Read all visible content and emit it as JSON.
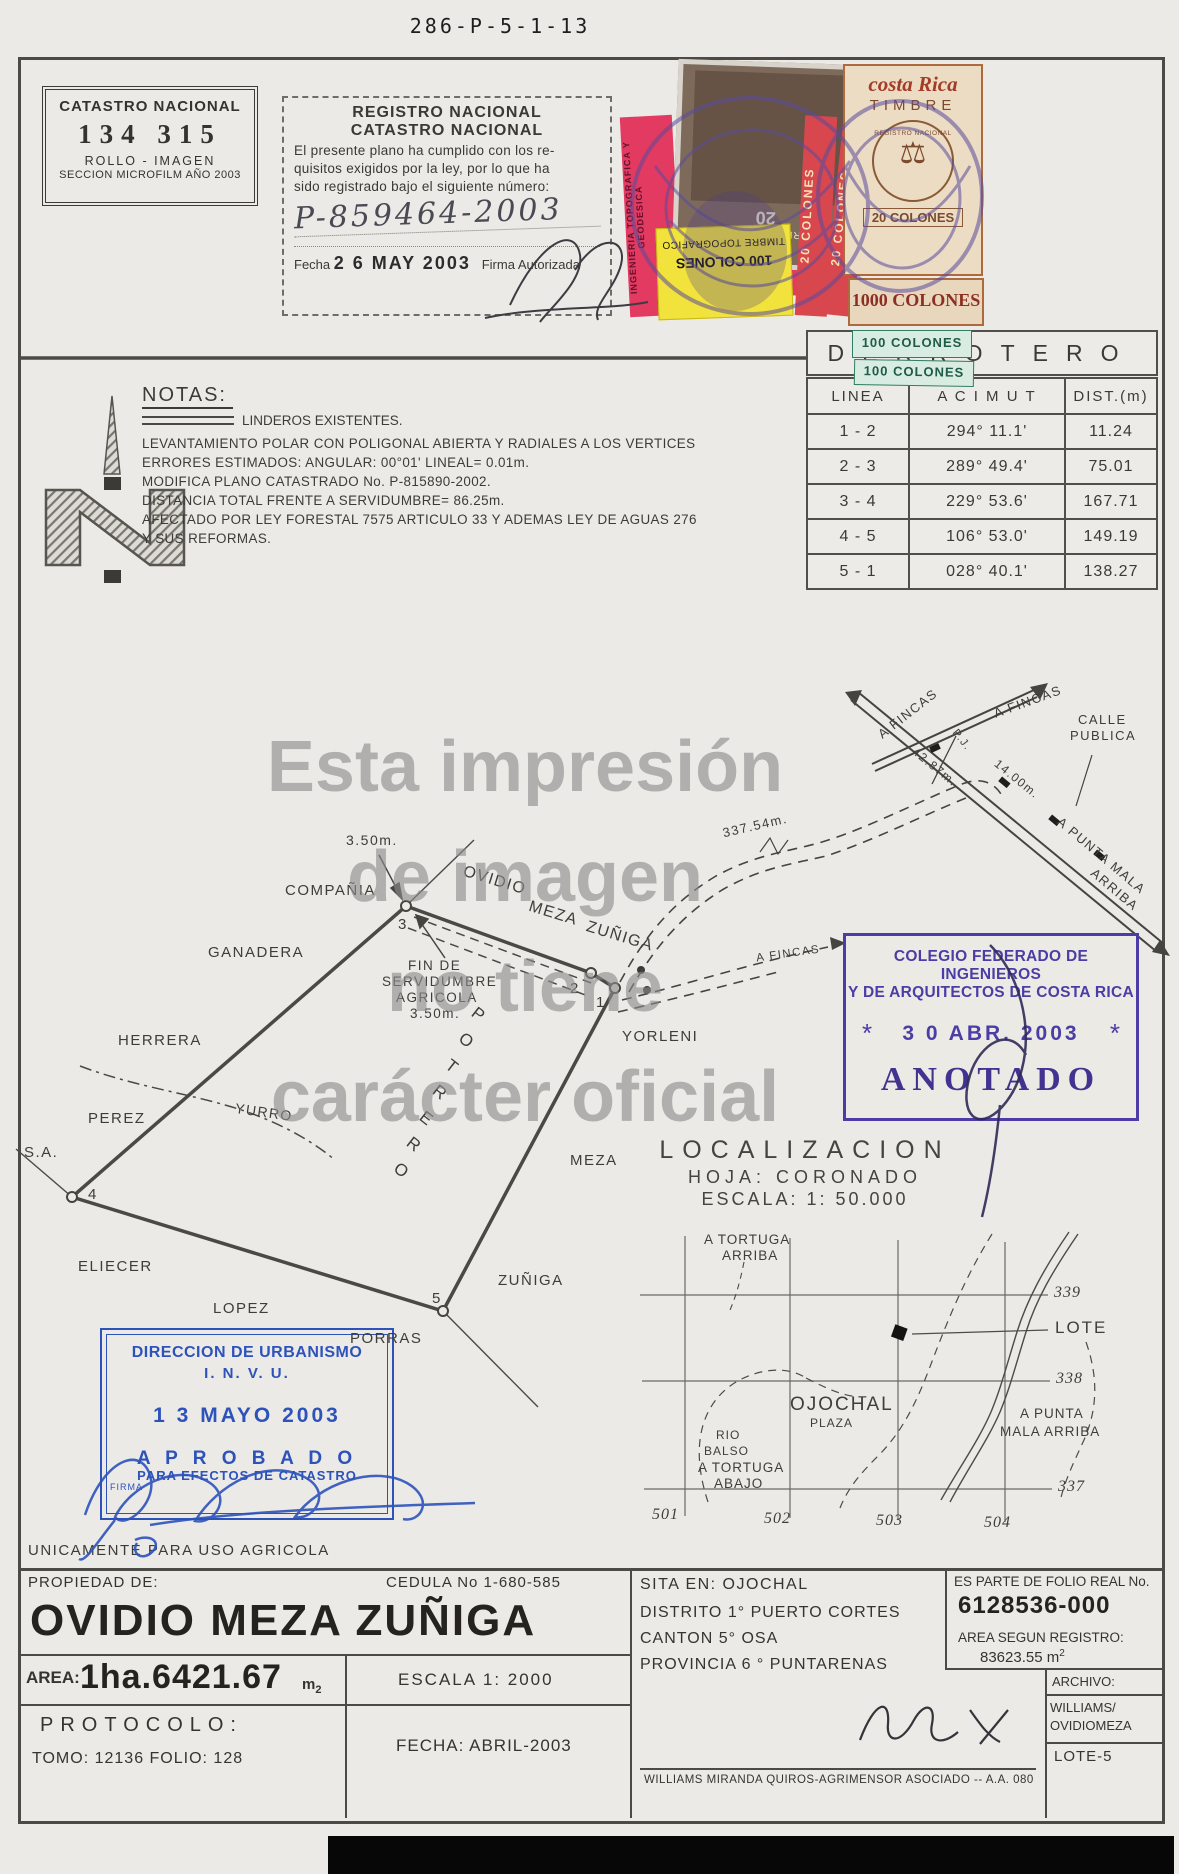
{
  "page": {
    "doc_number": "286-P-5-1-13"
  },
  "catastro_stamp": {
    "title": "CATASTRO NACIONAL",
    "number": "134 315",
    "rollo": "ROLLO - IMAGEN",
    "seccion": "SECCION MICROFILM AÑO 2003"
  },
  "registro_stamp": {
    "title1": "REGISTRO NACIONAL",
    "title2": "CATASTRO NACIONAL",
    "body1": "El presente plano ha cumplido con los re-",
    "body2": "quisitos exigidos por la ley, por lo que ha",
    "body3": "sido registrado bajo el siguiente número:",
    "numero": "P-859464-2003",
    "fecha_label": "Fecha",
    "fecha": "2 6 MAY 2003",
    "firma": "Firma Autorizada"
  },
  "timbres": {
    "archivos_name": "TIMBRE DE ARCHIVOS",
    "archivos_valor": "20",
    "ingenieria": "INGENIERIA TOPOGRAFICA Y GEODESICA",
    "topografico_valor": "100 COLONES",
    "topografico_name": "TIMBRE TOPOGRAFICO",
    "colones20": "20 COLONES",
    "cr_pais": "costa Rica",
    "cr_tipo": "TIMBRE",
    "cr_seal": "REGISTRO NACIONAL",
    "cr_valor": "20 COLONES",
    "colones1000": "1000 COLONES",
    "colones100": "100 COLONES"
  },
  "notas": {
    "title": "NOTAS:",
    "linderos": "LINDEROS EXISTENTES.",
    "lines": [
      "LEVANTAMIENTO POLAR CON POLIGONAL ABIERTA Y RADIALES A LOS VERTICES",
      "ERRORES ESTIMADOS: ANGULAR:  00°01'      LINEAL= 0.01m.",
      "MODIFICA PLANO CATASTRADO No. P-815890-2002.",
      "DISTANCIA TOTAL FRENTE A SERVIDUMBRE= 86.25m.",
      "AFECTADO POR LEY FORESTAL 7575 ARTICULO 33 Y ADEMAS LEY DE AGUAS 276",
      "Y SUS REFORMAS."
    ]
  },
  "derrotero": {
    "title": "DERROTERO",
    "col_linea": "LINEA",
    "col_acimut": "A C I M U T",
    "col_dist": "DIST.(m)",
    "rows": [
      {
        "linea": "1 - 2",
        "acimut": "294° 11.1'",
        "dist": "11.24"
      },
      {
        "linea": "2 - 3",
        "acimut": "289° 49.4'",
        "dist": "75.01"
      },
      {
        "linea": "3 - 4",
        "acimut": "229° 53.6'",
        "dist": "167.71"
      },
      {
        "linea": "4 - 5",
        "acimut": "106° 53.0'",
        "dist": "149.19"
      },
      {
        "linea": "5 - 1",
        "acimut": "028° 40.1'",
        "dist": "138.27"
      }
    ]
  },
  "watermark": {
    "l1": "Esta impresión",
    "l2": "de imagen",
    "l3": "no tiene",
    "l4": "carácter oficial"
  },
  "plot": {
    "v1": "1",
    "v2": "2",
    "v3": "3",
    "v4": "4",
    "v5": "5",
    "compania": "COMPAÑIA",
    "ganadera": "GANADERA",
    "herrera": "HERRERA",
    "perez": "PEREZ",
    "sa": "S.A.",
    "yurro": "YURRO",
    "eliecer": "ELIECER",
    "lopez": "LOPEZ",
    "porras": "PORRAS",
    "ovidio": "OVIDIO",
    "meza": "MEZA",
    "zuniga": "ZUÑIGA",
    "yorleni": "YORLENI",
    "meza2": "MEZA",
    "zuniga2": "ZUÑIGA",
    "potrero": [
      "P",
      "O",
      "T",
      "R",
      "E",
      "R",
      "O"
    ],
    "d350": "3.50m.",
    "fin1": "FIN DE",
    "fin2": "SERVIDUMBRE",
    "fin3": "AGRICOLA",
    "fin4": "3.50m.",
    "afincas1": "A FINCAS",
    "afincas2": "A FINCAS",
    "afincas3": "A FINCAS",
    "calle1": "CALLE",
    "calle2": "PUBLICA",
    "pj": "P.J.",
    "d4287": "42.87m.",
    "d1400": "14.00m.",
    "d33754": "337.54m.",
    "punta1": "A PUNTA MALA",
    "punta2": "ARRIBA"
  },
  "colegio_stamp": {
    "l1": "COLEGIO FEDERADO DE INGENIEROS",
    "l2": "Y DE ARQUITECTOS DE COSTA RICA",
    "star_left": "*",
    "star_right": "*",
    "fecha": "3 0 ABR. 2003",
    "anotado": "ANOTADO"
  },
  "localizacion": {
    "title": "LOCALIZACION",
    "hoja": "HOJA: CORONADO",
    "escala": "ESCALA:    1: 50.000"
  },
  "locmap": {
    "g339": "339",
    "g338": "338",
    "g337": "337",
    "g501": "501",
    "g502": "502",
    "g503": "503",
    "g504": "504",
    "lote": "LOTE",
    "ojochal": "OJOCHAL",
    "plaza": "PLAZA",
    "rio": "RIO",
    "balso": "BALSO",
    "tarriba1": "A TORTUGA",
    "tarriba2": "ARRIBA",
    "tabajo1": "A TORTUGA",
    "tabajo2": "ABAJO",
    "punta1": "A PUNTA",
    "punta2": "MALA ARRIBA"
  },
  "invu_stamp": {
    "l1": "DIRECCION DE URBANISMO",
    "l2": "I. N. V. U.",
    "fecha": "1 3 MAYO 2003",
    "aprobado": "A P R O B A D O",
    "para": "PARA EFECTOS DE CATASTRO",
    "firma": "FIRMA"
  },
  "uso_agricola": "UNICAMENTE PARA USO AGRICOLA",
  "info": {
    "propiedad_label": "PROPIEDAD DE:",
    "cedula": "CEDULA No 1-680-585",
    "owner": "OVIDIO MEZA ZUÑIGA",
    "sita": "SITA EN:  OJOCHAL",
    "distrito": "DISTRITO 1° PUERTO CORTES",
    "canton": "CANTON      5° OSA",
    "provincia": "PROVINCIA 6 ° PUNTARENAS",
    "folio_label": "ES PARTE DE FOLIO REAL No.",
    "folio": "6128536-000",
    "area_registro_label": "AREA SEGUN REGISTRO:",
    "area_registro": "83623.55 m",
    "sup2": "2",
    "area_label": "AREA:",
    "area": "1ha.6421.67",
    "area_unit": "m",
    "escala": "ESCALA   1: 2000",
    "protocolo": "PROTOCOLO:",
    "tomo": "TOMO:  12136     FOLIO:  128",
    "fecha": "FECHA:  ABRIL-2003",
    "agrimensor": "WILLIAMS MIRANDA QUIROS-AGRIMENSOR ASOCIADO  --  A.A. 080",
    "archivo_label": "ARCHIVO:",
    "archivo1": "WILLIAMS/",
    "archivo2": "OVIDIOMEZA",
    "archivo3": "LOTE-5"
  }
}
